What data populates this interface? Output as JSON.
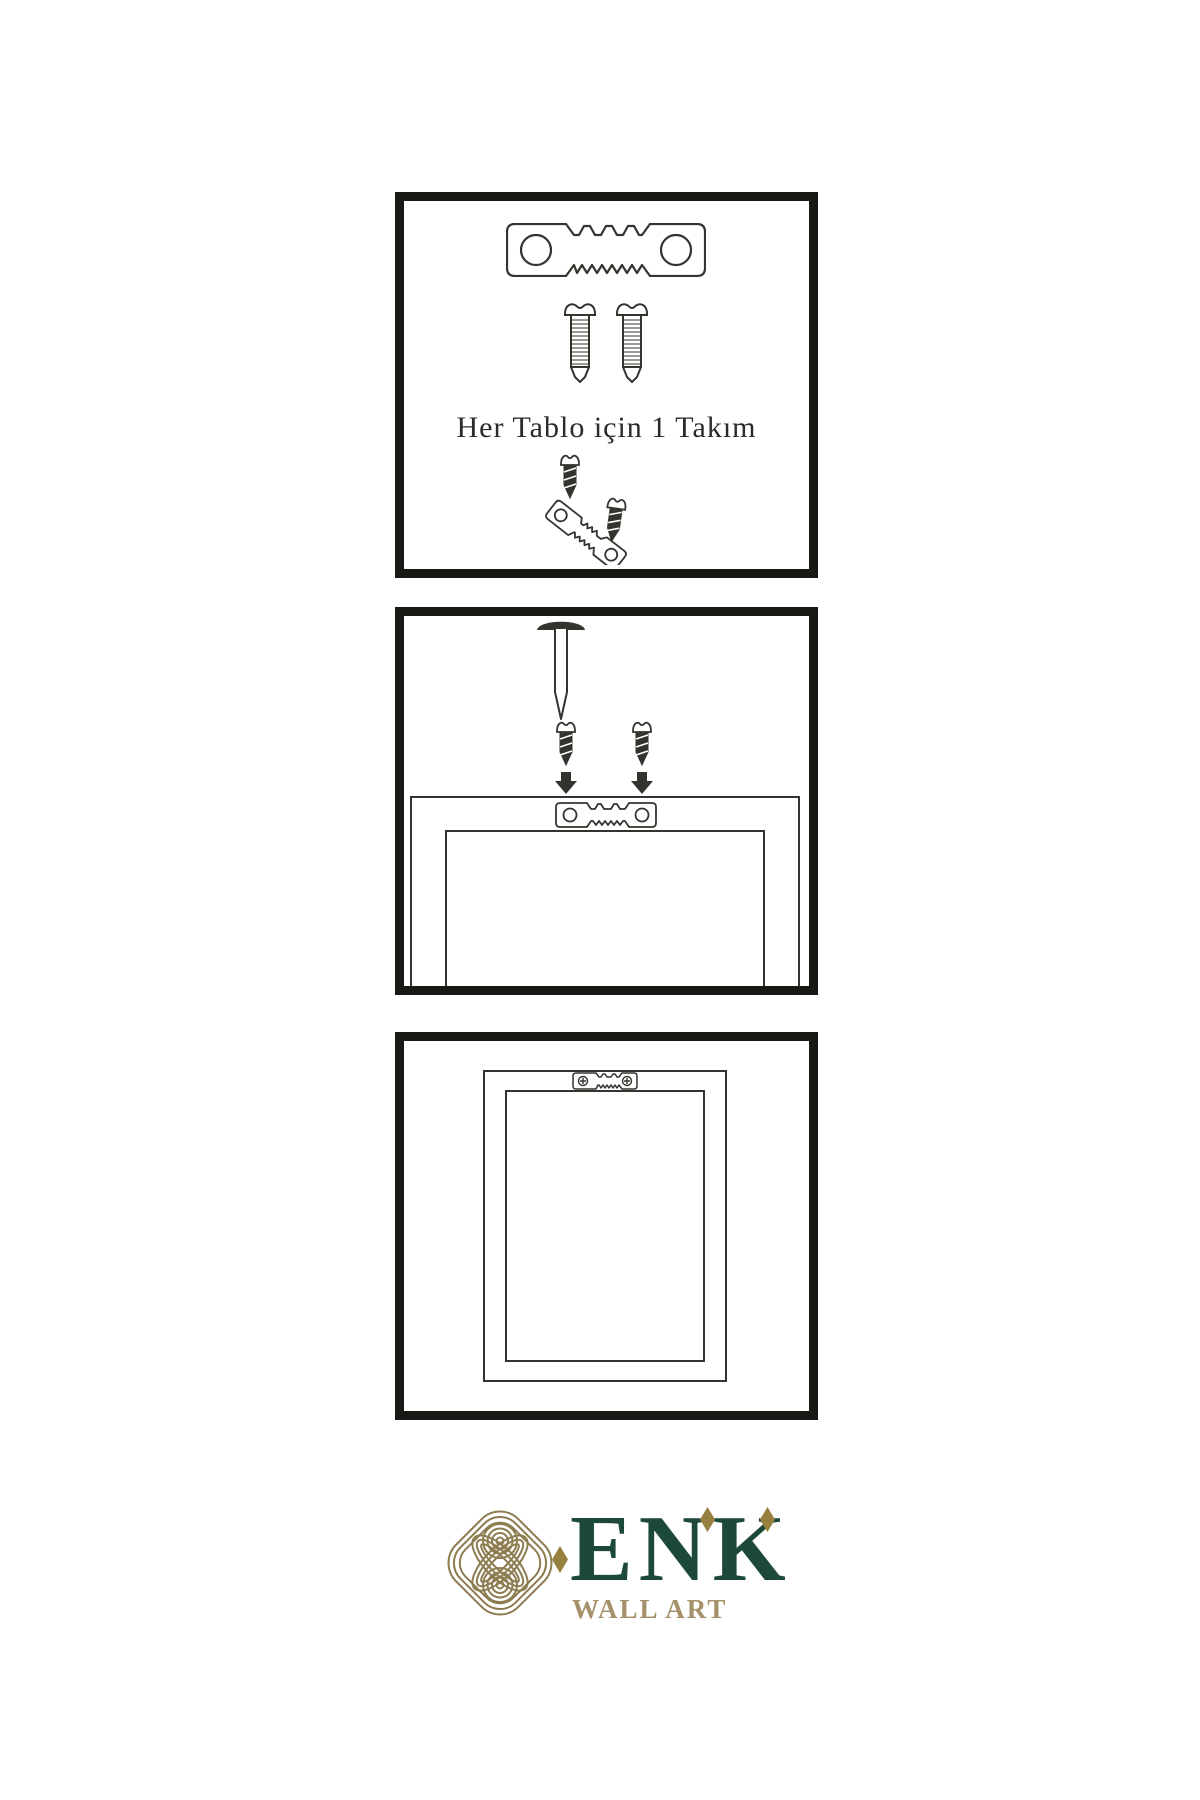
{
  "theme": {
    "bg": "#ffffff",
    "ink": "#181815",
    "line": "#34342f",
    "text": "#2b2b28",
    "green": "#1d4a38",
    "gold": "#8d7c50",
    "gold-dark": "#96803f",
    "gold-text": "#a5906a"
  },
  "steps": [
    {
      "id": "hardware-kit",
      "caption": "Her Tablo için 1 Takım"
    },
    {
      "id": "attach-hanger-to-frame"
    },
    {
      "id": "frame-hung-on-wall"
    }
  ],
  "logo": {
    "brand": "ENK",
    "tagline": "WALL ART"
  },
  "icons": {
    "sawtooth-hanger-icon": "svg-plate-with-teeth",
    "screw-icon": "svg-threaded-screw",
    "dark-screw-icon": "svg-short-screw",
    "nail-icon": "svg-wall-nail",
    "down-arrow-icon": "svg-solid-arrow",
    "hanger-assembly-icon": "svg-angled-plate-with-screws",
    "knot-logo-icon": "svg-interlaced-knot",
    "diamond-icon": "svg-lozenge"
  }
}
